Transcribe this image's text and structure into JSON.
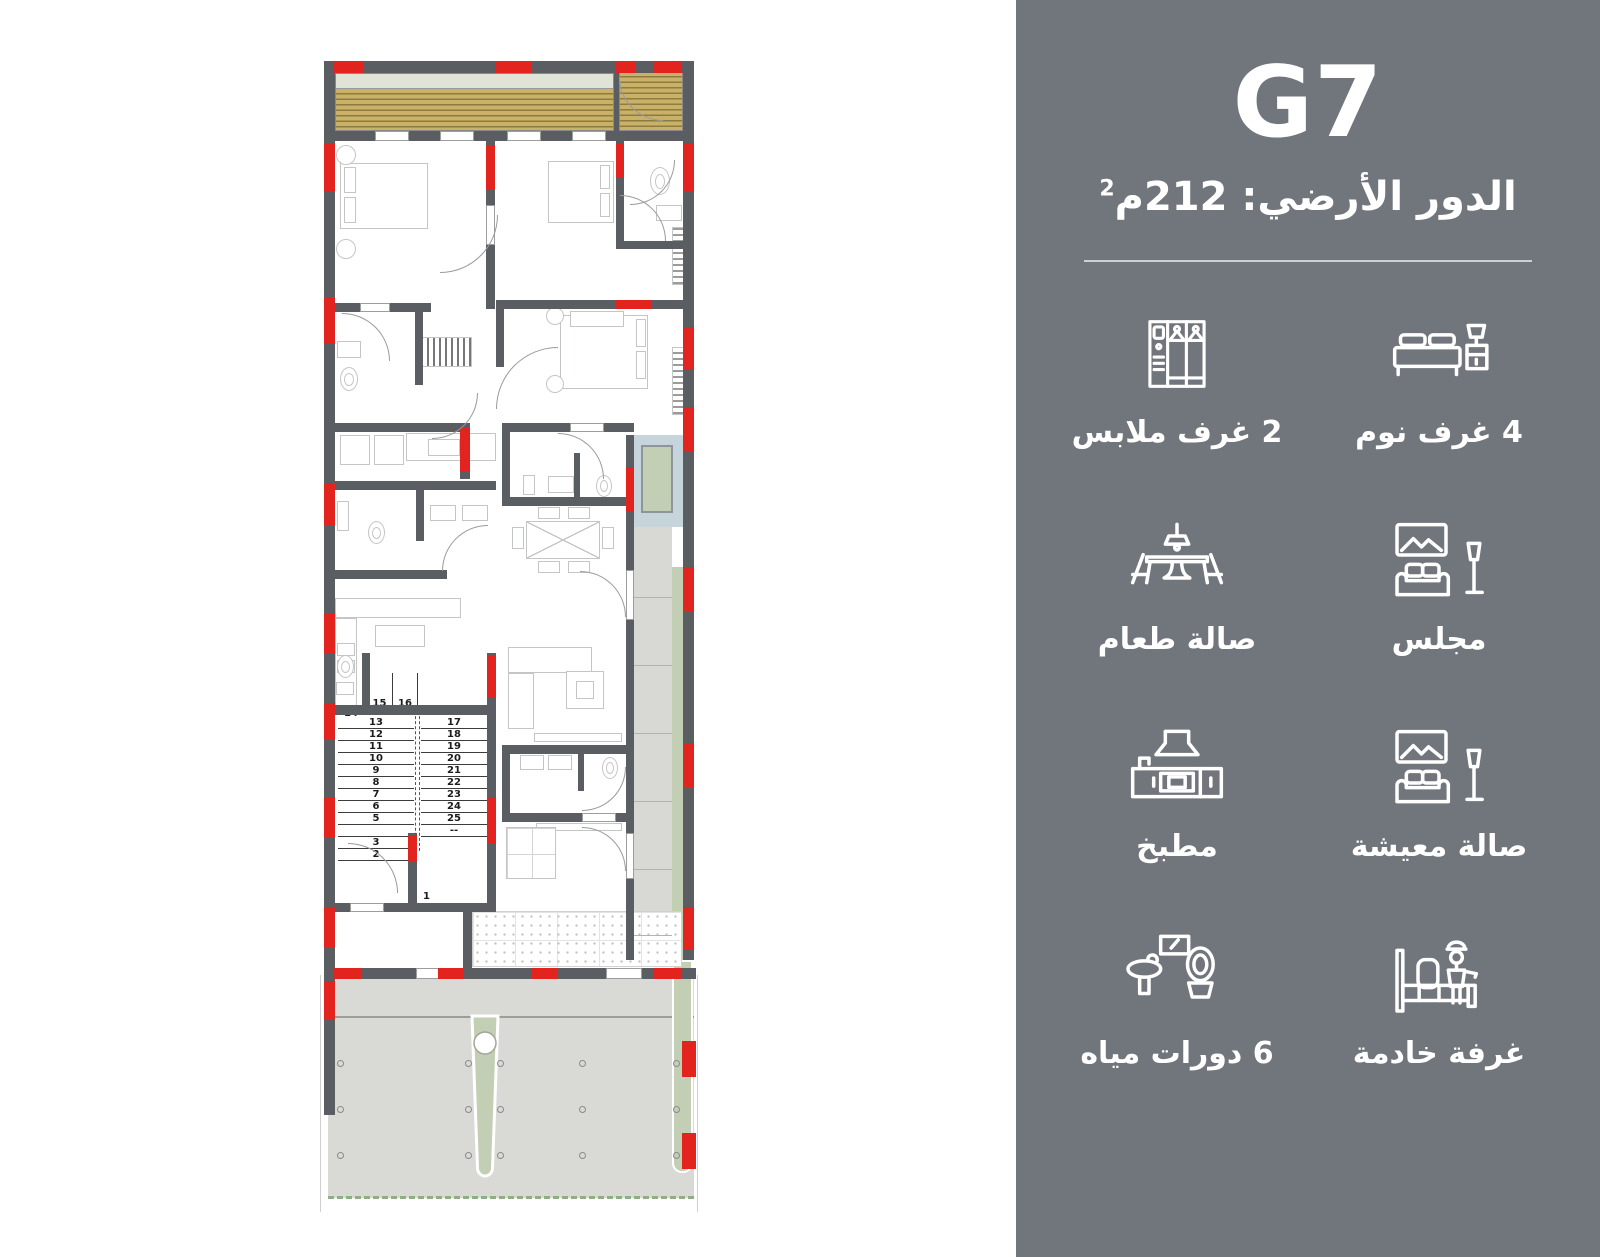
{
  "panel": {
    "unit": "G7",
    "floor_label": "الدور الأرضي:",
    "area_value": "212",
    "area_unit": "م",
    "area_sup": "2",
    "features": [
      {
        "icon": "bed-icon",
        "label": "4 غرف نوم"
      },
      {
        "icon": "wardrobe-icon",
        "label": "2 غرف ملابس"
      },
      {
        "icon": "majlis-sofa-icon",
        "label": "مجلس"
      },
      {
        "icon": "dining-table-icon",
        "label": "صالة طعام"
      },
      {
        "icon": "living-sofa-icon",
        "label": "صالة معيشة"
      },
      {
        "icon": "kitchen-icon",
        "label": "مطبخ"
      },
      {
        "icon": "maid-room-icon",
        "label": "غرفة خادمة"
      },
      {
        "icon": "bathroom-icon",
        "label": "6 دورات مياه"
      }
    ]
  },
  "plan": {
    "stairs": {
      "upper_left_number": "14",
      "landing_numbers": [
        "15",
        "16"
      ],
      "left_flight": [
        "13",
        "12",
        "11",
        "10",
        "9",
        "8",
        "7",
        "6",
        "5",
        "",
        "3",
        "2"
      ],
      "right_flight": [
        "17",
        "18",
        "19",
        "20",
        "21",
        "22",
        "23",
        "24",
        "25",
        "--"
      ],
      "bottom_number": "1"
    }
  },
  "colors": {
    "panel_bg": "#71757c",
    "accent_red": "#e2231e",
    "wall_gray": "#5a5d61",
    "wood_tan": "#c9b267",
    "pergola_green": "#dfe4d7",
    "skylight_blue": "#c6d5db",
    "courtyard_green": "#c2cfb5",
    "yard_gray": "#d9dad6"
  }
}
